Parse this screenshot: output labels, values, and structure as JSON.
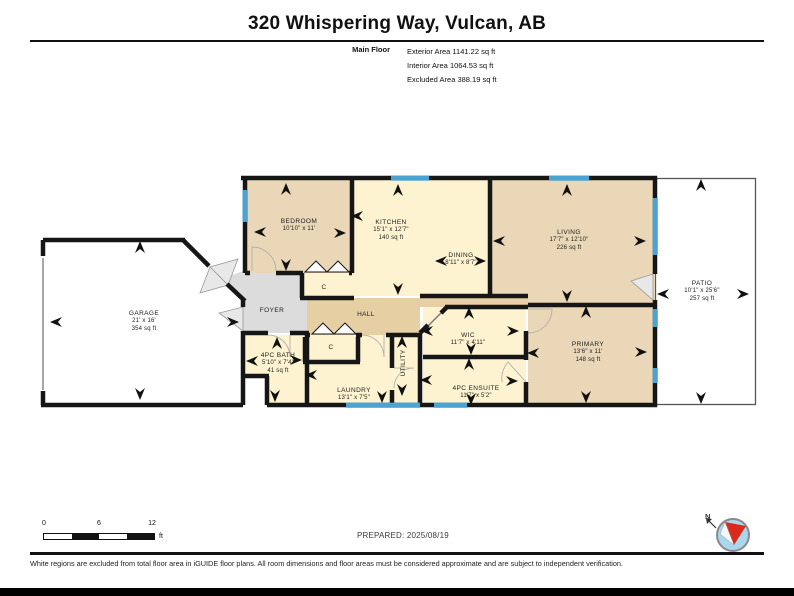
{
  "document": {
    "title": "320 Whispering Way, Vulcan, AB",
    "floor": {
      "label": "Main Floor",
      "stats": [
        {
          "text": "Exterior Area 1141.22 sq ft"
        },
        {
          "text": "Interior Area 1064.53 sq ft"
        },
        {
          "text": "Excluded Area 388.19 sq ft"
        }
      ]
    }
  },
  "rooms": [
    {
      "label": "GARAGE",
      "dims": "21' x 16'",
      "area": "354 sq ft"
    },
    {
      "label": "BEDROOM",
      "dims": "10'10\" x 11'"
    },
    {
      "label": "KITCHEN",
      "dims": "15'1\" x 12'7\"",
      "area": "140 sq ft"
    },
    {
      "label": "DINING",
      "dims": "8'11\" x 8'7\""
    },
    {
      "label": "LIVING",
      "dims": "17'7\" x 12'10\"",
      "area": "226 sq ft"
    },
    {
      "label": "PATIO",
      "dims": "10'1\" x 25'6\"",
      "area": "257 sq ft"
    },
    {
      "label": "FOYER"
    },
    {
      "label": "HALL"
    },
    {
      "label": "C"
    },
    {
      "label": "C"
    },
    {
      "label": "4PC BATH",
      "dims": "5'10\" x 7'4\"",
      "area": "41 sq ft"
    },
    {
      "label": "LAUNDRY",
      "dims": "13'1\" x 7'5\""
    },
    {
      "label": "UTILITY"
    },
    {
      "label": "WIC",
      "dims": "11'7\" x 4'11\""
    },
    {
      "label": "4PC ENSUITE",
      "dims": "11'7\" x 5'2\""
    },
    {
      "label": "PRIMARY",
      "dims": "13'6\" x 11'",
      "area": "148 sq ft"
    }
  ],
  "scale_bar": {
    "ticks": [
      "0",
      "6",
      "12"
    ],
    "unit": "ft"
  },
  "prepared_label": "PREPARED: 2025/08/19",
  "compass": {
    "north_label": "N"
  },
  "disclaimer": "White regions are excluded from total floor area in iGUIDE floor plans. All room dimensions and floor areas must be considered approximate and are subject to independent verification.",
  "colors": {
    "wall": "#161616",
    "window_blue": "#4aa3d1",
    "room_tan": "#ead7b7",
    "room_pale_yellow": "#fdf3d0",
    "hall_tan": "#e7cfa4",
    "foyer_gray": "#dcdcdc",
    "compass_fill": "#a9d7ee",
    "compass_needle": "#d92b1c"
  }
}
